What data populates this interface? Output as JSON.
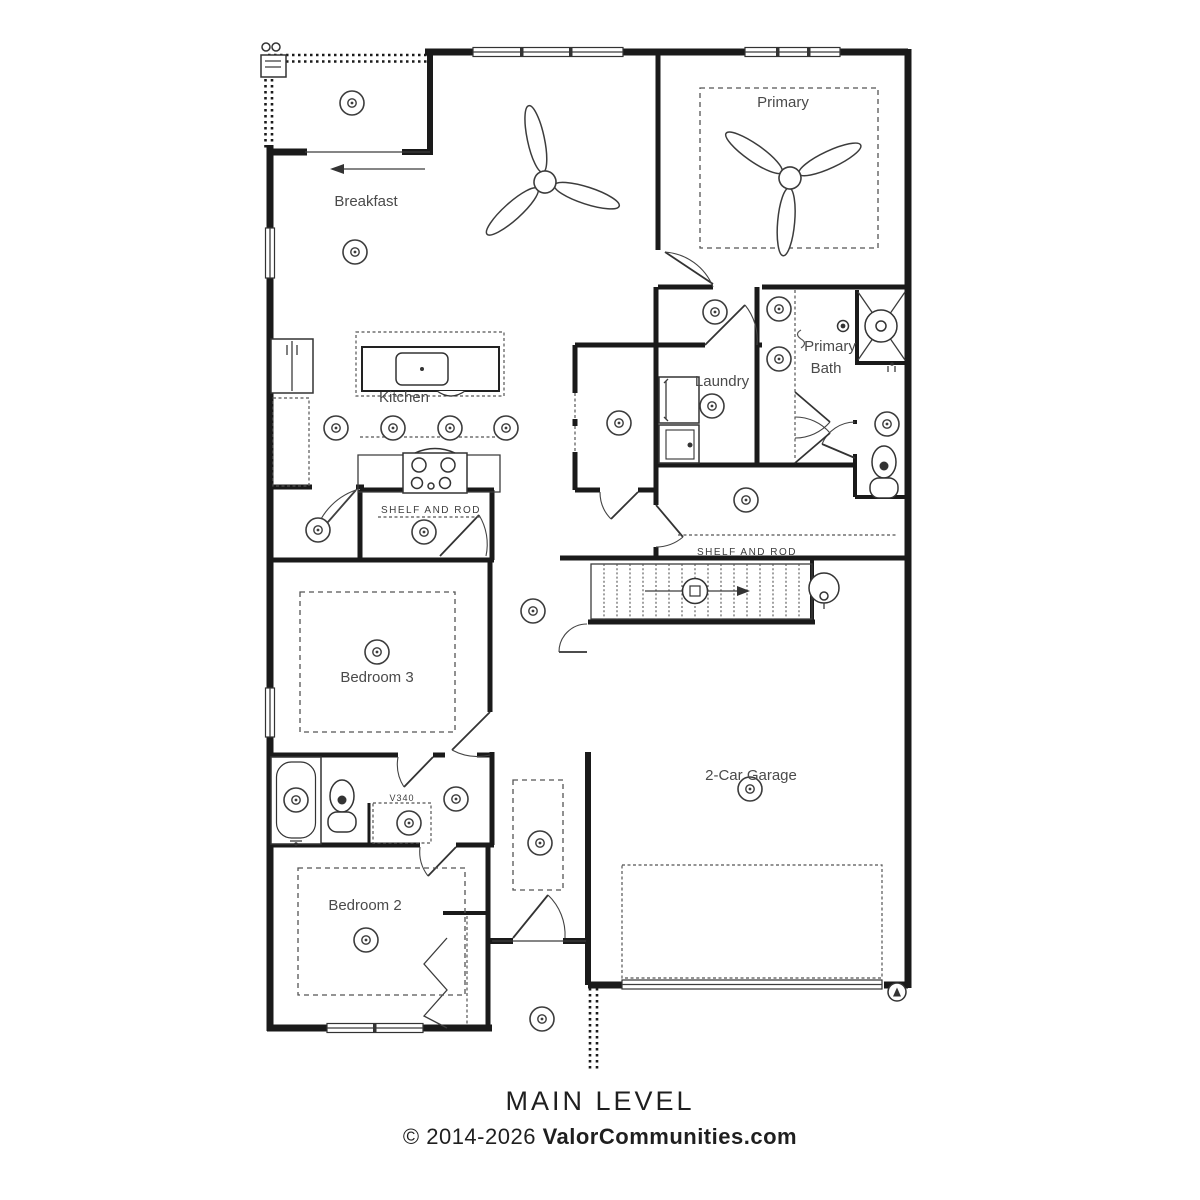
{
  "plan": {
    "name": "floor-plan-main-level",
    "rooms": {
      "breakfast": "Breakfast",
      "primary": "Primary",
      "kitchen": "Kitchen",
      "laundry": "Laundry",
      "primary_bath_line1": "Primary",
      "primary_bath_line2": "Bath",
      "bedroom3": "Bedroom 3",
      "bedroom2": "Bedroom 2",
      "garage": "2-Car Garage"
    },
    "annotations": {
      "shelf_and_rod": "SHELF AND ROD",
      "vanity_code": "V340"
    },
    "icons": {
      "recessed_light": "concentric-circles",
      "ceiling_fan": "three-blade-fan",
      "stairs": "treads-with-direction-arrow",
      "water_heater": "circle",
      "shower": "x-box",
      "grill": "corner-appliance"
    },
    "colors": {
      "wall": "#1a1a1a",
      "line": "#3c3c3c",
      "label": "#4a4a4a",
      "background": "#ffffff"
    }
  },
  "footer": {
    "title": "MAIN LEVEL",
    "copyright_prefix": "© 2014-2026 ",
    "copyright_site": "ValorCommunities.com"
  }
}
